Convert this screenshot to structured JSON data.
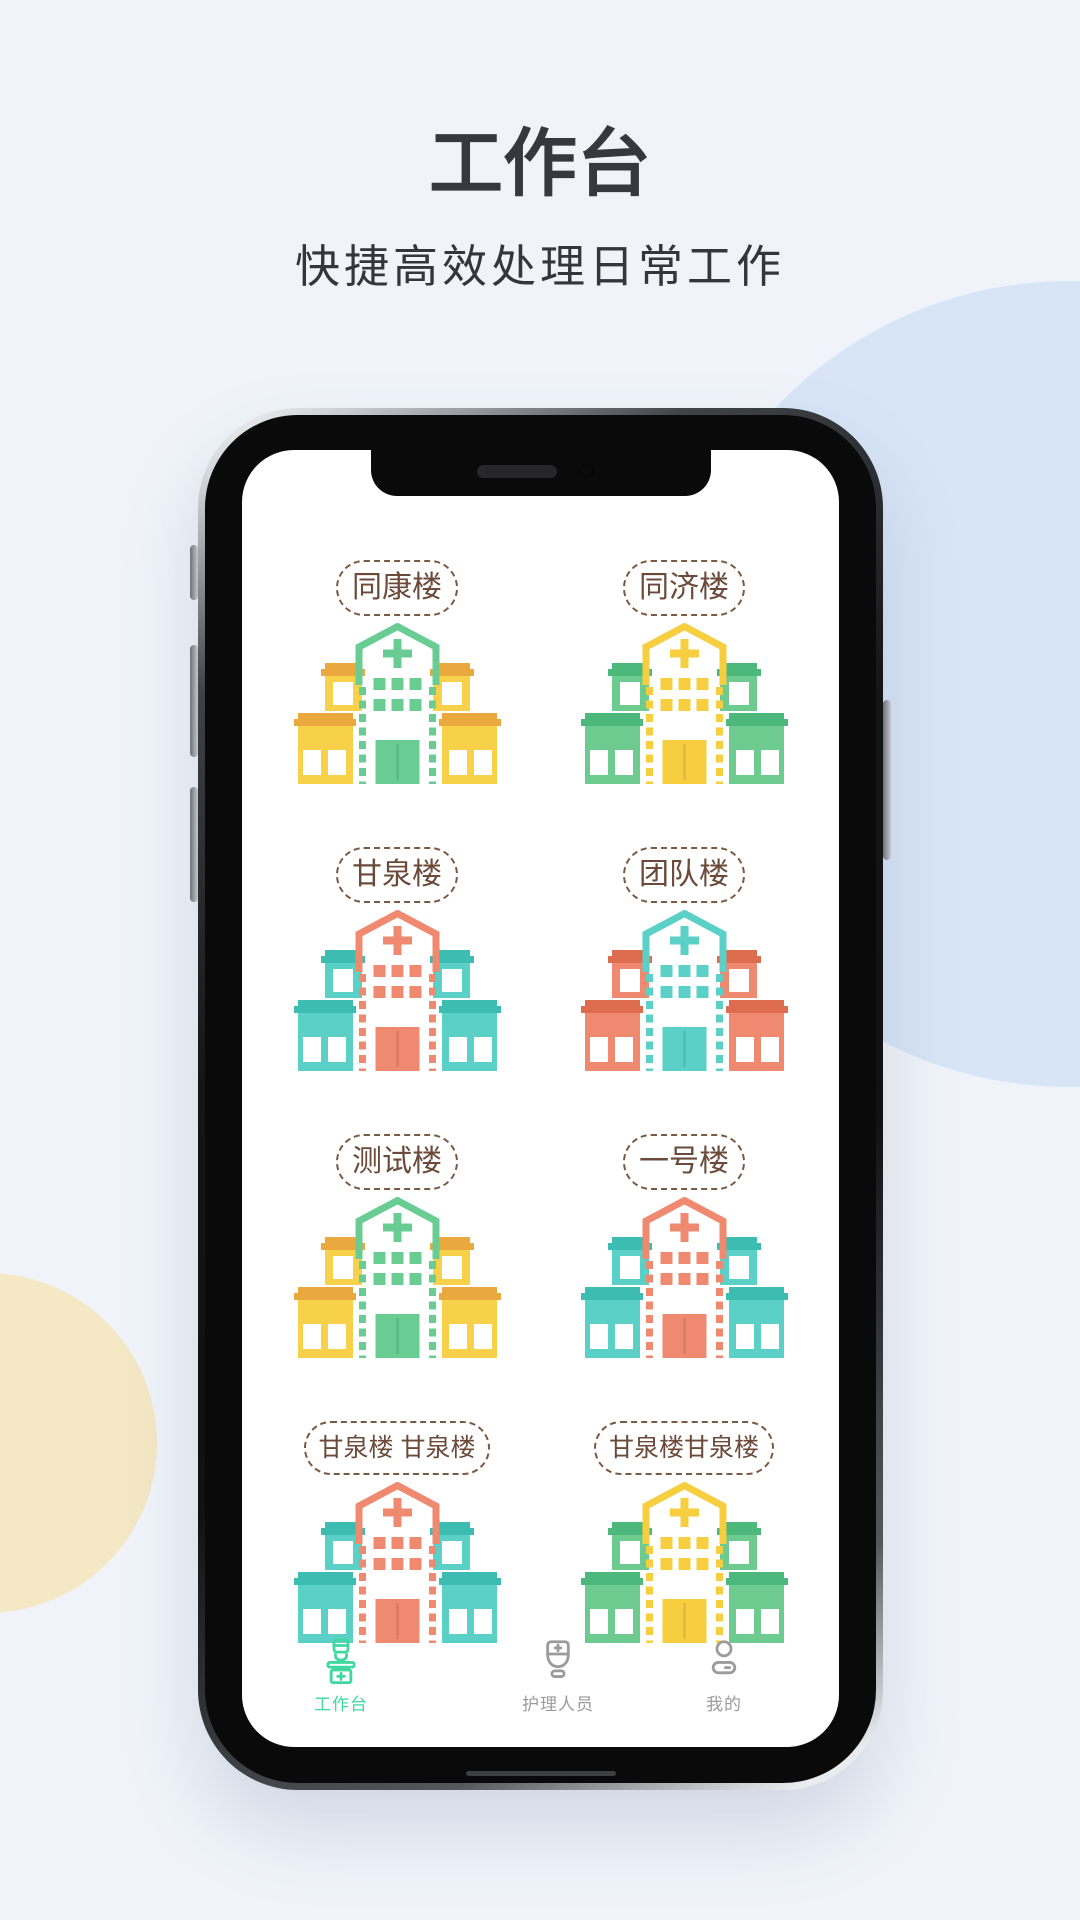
{
  "page": {
    "title": "工作台",
    "subtitle": "快捷高效处理日常工作",
    "background_color": "#f0f4fa",
    "decor": {
      "blue_circle_color": "#d8e5f7",
      "beige_circle_color": "#f5e8c5"
    }
  },
  "app": {
    "buildings": [
      {
        "label": "同康楼",
        "variant": "green-yellow"
      },
      {
        "label": "同济楼",
        "variant": "yellow-green"
      },
      {
        "label": "甘泉楼",
        "variant": "salmon-teal"
      },
      {
        "label": "团队楼",
        "variant": "teal-salmon"
      },
      {
        "label": "测试楼",
        "variant": "green-yellow"
      },
      {
        "label": "一号楼",
        "variant": "salmon-teal"
      },
      {
        "label": "甘泉楼 甘泉楼",
        "variant": "salmon-teal"
      },
      {
        "label": "甘泉楼甘泉楼",
        "variant": "yellow-green"
      }
    ],
    "palettes": {
      "green-yellow": {
        "tower": "#69cd93",
        "wing": "#f8d14b",
        "wing_dark": "#e9a93e"
      },
      "yellow-green": {
        "tower": "#f6ce40",
        "wing": "#6ecb8f",
        "wing_dark": "#4db87b"
      },
      "salmon-teal": {
        "tower": "#ef8a70",
        "wing": "#5ad0c7",
        "wing_dark": "#3dbcb1"
      },
      "teal-salmon": {
        "tower": "#5ad0c7",
        "wing": "#ef8a70",
        "wing_dark": "#de6c4f"
      }
    },
    "label_pill": {
      "text_color": "#6b4a3a",
      "border_color": "#7b5a44"
    },
    "tabbar": {
      "active_color": "#3fd9a0",
      "inactive_color": "#9b9b9b",
      "items": [
        {
          "label": "工作台",
          "icon": "workbench-icon",
          "active": true
        },
        {
          "label": "护理人员",
          "icon": "nurse-icon",
          "active": false
        },
        {
          "label": "我的",
          "icon": "user-icon",
          "active": false
        }
      ]
    }
  }
}
